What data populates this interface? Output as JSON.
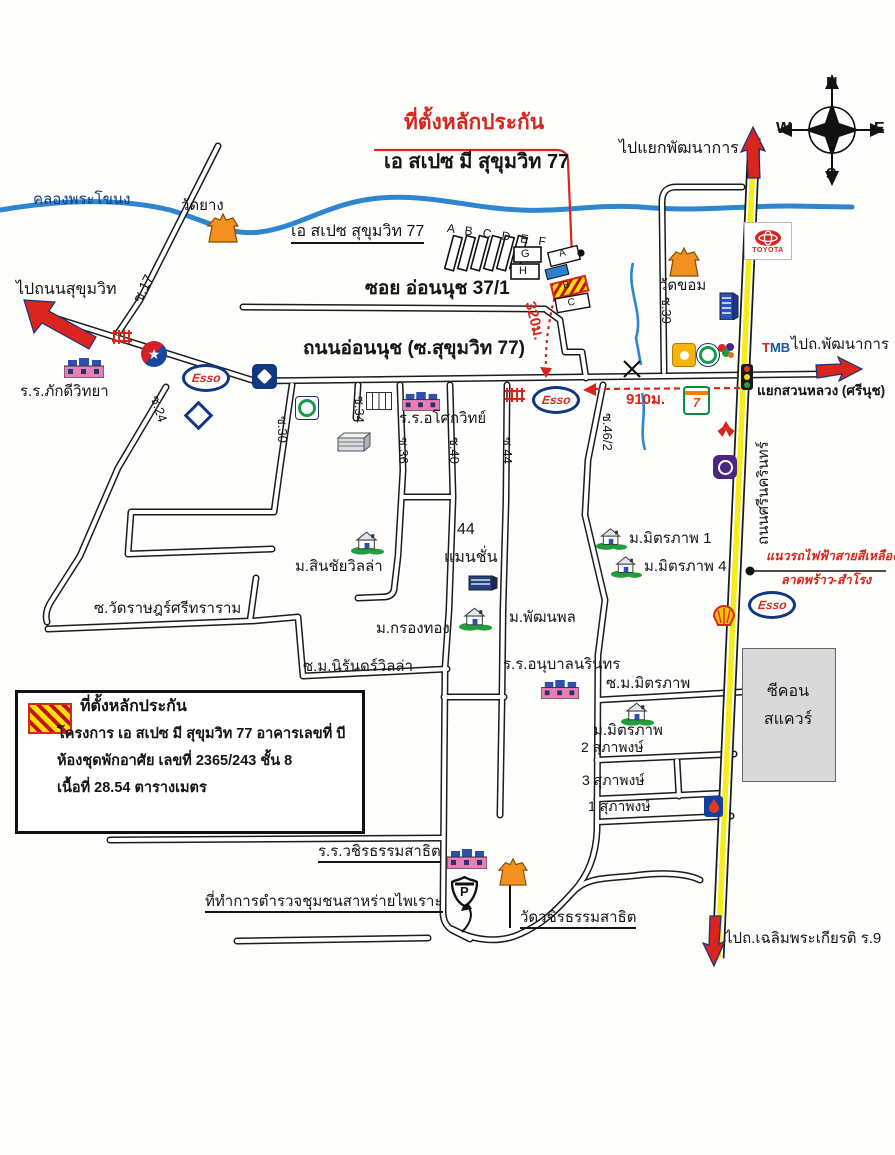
{
  "header": {
    "collateral_title": "ที่ตั้งหลักประกัน",
    "project_title": "เอ สเปซ มี สุขุมวิท 77"
  },
  "compass": {
    "n": "N",
    "e": "E",
    "s": "S",
    "w": "W"
  },
  "waterways": {
    "khlong": "คลองพระโขนง"
  },
  "roads": {
    "onnut": "ถนนอ่อนนุช (ซ.สุขุมวิท 77)",
    "soi_onnut_37_1": "ซอย อ่อนนุช 37/1",
    "srinagarindra": "ถนนศรีนครินทร์",
    "soi17": "ซ.17",
    "soi24": "ซ.24",
    "soi30": "ซ.30",
    "soi34": "ซ.34",
    "soi36": "ซ.36",
    "soi39": "ซ.39",
    "soi40": "ซ.40",
    "soi44": "ซ.44",
    "soi46_2": "ซ.46/2",
    "soi_wat_rat": "ซ.วัดราษฎร์ศรีทราราม",
    "soi_nirand": "ซ.ม.นิรันดร์วิลล่า",
    "soi_mitraphap": "ซ.ม.มิตรภาพ",
    "suphapong1": "1 สุภาพงษ์",
    "suphapong2": "2 สุภาพงษ์",
    "suphapong3": "3 สุภาพงษ์"
  },
  "directions": {
    "to_phatthanakan_junction": "ไปแยกพัฒนาการ",
    "to_sukhumvit": "ไปถนนสุขุมวิท",
    "to_phatthanakan": "ไปถ.พัฒนาการ",
    "to_chalermprakiat": "ไปถ.เฉลิมพระเกียรติ ร.9",
    "suan_luang_junction": "แยกสวนหลวง (ศรีนุช)"
  },
  "places": {
    "wat_yang": "วัดยาง",
    "wat_khom": "วัดขอม",
    "a_space": "เอ สเปซ สุขุมวิท 77",
    "pakdee_school": "ร.ร.ภักดีวิทยา",
    "asoke_school": "ร.ร.อโศกวิทย์",
    "sinchai_villa": "ม.สินชัยวิลล่า",
    "mansion44_line1": "44",
    "mansion44_line2": "แมนชั่น",
    "krongthong": "ม.กรองทอง",
    "pattanapol": "ม.พัฒนพล",
    "anuban_school": "ร.ร.อนุบาลนรินทร",
    "mitraphap1": "ม.มิตรภาพ 1",
    "mitraphap4": "ม.มิตรภาพ 4",
    "mitraphap": "ม.มิตรภาพ",
    "seacon_line1": "ซีคอน",
    "seacon_line2": "สแควร์",
    "wachiratham_school": "ร.ร.วชิรธรรมสาธิต",
    "police_office": "ที่ทำการตำรวจชุมชนสาหร่ายไพเราะ",
    "wat_wachiratham": "วัดวชิรธรรมสาธิต"
  },
  "measurements": {
    "d320": "320ม.",
    "d910": "910ม."
  },
  "transit": {
    "mrt_line1": "แนวรถไฟฟ้าสายสีเหลือง",
    "mrt_line2": "ลาดพร้าว-สำโรง"
  },
  "buildings": {
    "letters_row": "A B C D E F",
    "g": "G",
    "h": "H",
    "unit_a": "A",
    "unit_b": "B",
    "unit_c": "C"
  },
  "legend": {
    "title": "ที่ตั้งหลักประกัน",
    "line1": "โครงการ เอ สเปซ มี สุขุมวิท 77 อาคารเลขที่ บี",
    "line2": "ห้องชุดพักอาศัย เลขที่ 2365/243 ชั้น 8",
    "line3": "เนื้อที่ 28.54 ตารางเมตร"
  },
  "logos": {
    "esso": "Esso",
    "toyota": "TOYOTA",
    "tmb_t": "T",
    "tmb_mb": "MB",
    "seven": "7",
    "police_p": "P"
  },
  "colors": {
    "road_casing": "#1c1c1c",
    "river_blue": "#2f86d0",
    "highway_yellow": "#f6ec1a",
    "accent_red": "#d9251d",
    "temple_orange": "#f2911f",
    "navy": "#10377f",
    "green": "#1f9e3a",
    "purple": "#4a2683",
    "legend_hatch_yellow": "#ffe000"
  }
}
